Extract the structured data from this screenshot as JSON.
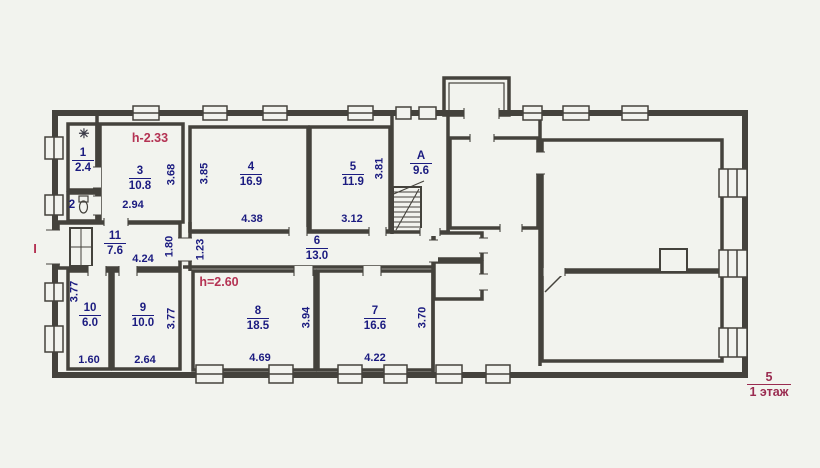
{
  "colors": {
    "wall": "#44423c",
    "navy_text": "#1b1b80",
    "red_note": "#b43253",
    "maroon_caption": "#9a2b50",
    "paper": "#f2f3ee"
  },
  "icons": {
    "shower": "✳"
  },
  "rooms": [
    {
      "number": "1",
      "area": "2.4"
    },
    {
      "number": "2",
      "area": ""
    },
    {
      "number": "3",
      "area": "10.8"
    },
    {
      "number": "4",
      "area": "16.9"
    },
    {
      "number": "5",
      "area": "11.9"
    },
    {
      "number": "A",
      "area": "9.6"
    },
    {
      "number": "11",
      "area": "7.6"
    },
    {
      "number": "6",
      "area": "13.0"
    },
    {
      "number": "10",
      "area": "6.0"
    },
    {
      "number": "9",
      "area": "10.0"
    },
    {
      "number": "8",
      "area": "18.5"
    },
    {
      "number": "7",
      "area": "16.6"
    }
  ],
  "dimensions": [
    "2.94",
    "3.68",
    "3.85",
    "4.38",
    "3.12",
    "3.81",
    "4.24",
    "1.80",
    "1.23",
    "3.77",
    "1.60",
    "2.64",
    "3.77",
    "4.69",
    "3.94",
    "4.22",
    "3.70"
  ],
  "notes": {
    "height_note_upper": "h-2.33",
    "height_note_lower": "h=2.60",
    "entrance_mark": "I"
  },
  "caption": {
    "sheet_number": "5",
    "floor_label": "1 этаж"
  }
}
